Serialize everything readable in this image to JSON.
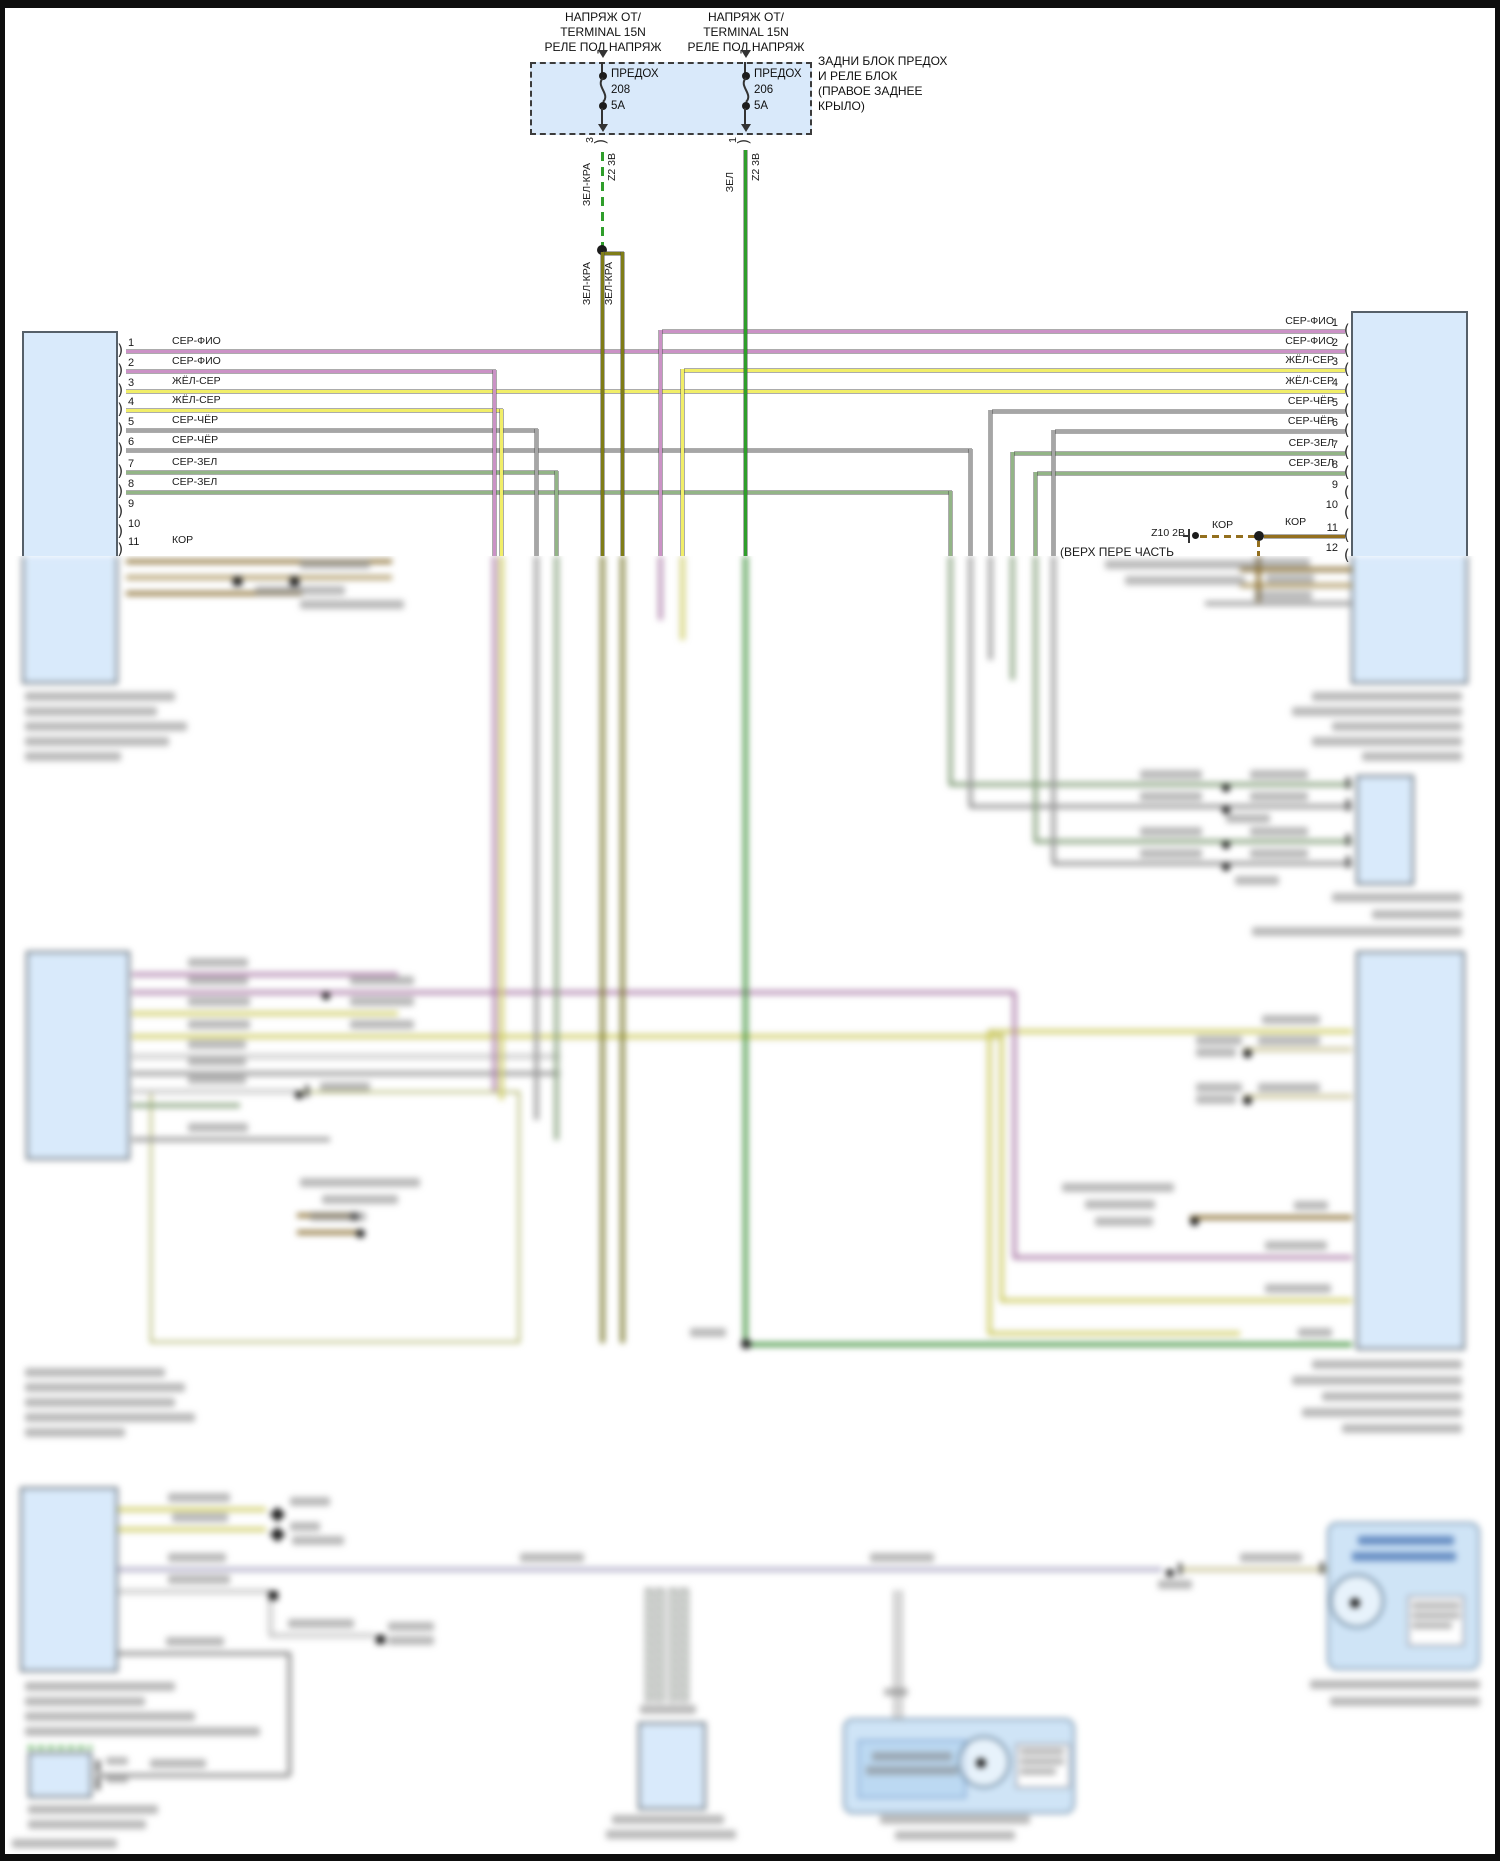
{
  "colors": {
    "pink": "#cb92c6",
    "yellow": "#f1ee68",
    "gray": "#a6a6a6",
    "green": "#93b587",
    "bright": "#2f9e2b",
    "olive": "#7f7d17",
    "brown": "#936f1e",
    "lavender": "#c7c3e6",
    "tan": "#c2a55e",
    "pale": "#ece5ad",
    "white": "#e3e3e3",
    "gray2": "#8a8a8a",
    "black": "#333333",
    "block_fill": "#d9eafb",
    "block_border": "#566069",
    "fusebox_fill": "#d9e9fa"
  },
  "top": {
    "feed_left": [
      "НАПРЯЖ ОТ/",
      "TERMINAL 15N",
      "РЕЛЕ ПОД НАПРЯЖ"
    ],
    "feed_right": [
      "НАПРЯЖ ОТ/",
      "TERMINAL 15N",
      "РЕЛЕ ПОД НАПРЯЖ"
    ],
    "box_label": [
      "ЗАДНИ БЛОК ПРЕДОХ",
      "И РЕЛЕ БЛОК",
      "(ПРАВОЕ ЗАДНЕЕ",
      "КРЫЛО)"
    ],
    "fuse_left": {
      "name": "ПРЕДОХ",
      "number": "208",
      "rating": "5А",
      "pin": "3",
      "wire": "ЗЕЛ-КРА",
      "circuit": "Z2 3В",
      "branch_wires": [
        "ЗЕЛ-КРА",
        "ЗЕЛ-КРА"
      ]
    },
    "fuse_right": {
      "name": "ПРЕДОХ",
      "number": "206",
      "rating": "5А",
      "pin": "1",
      "wire": "ЗЕЛ",
      "circuit": "Z2 3В"
    }
  },
  "left_connector": {
    "pins": [
      {
        "n": "1",
        "label": "СЕР-ФИО"
      },
      {
        "n": "2",
        "label": "СЕР-ФИО"
      },
      {
        "n": "3",
        "label": "ЖЁЛ-СЕР"
      },
      {
        "n": "4",
        "label": "ЖЁЛ-СЕР"
      },
      {
        "n": "5",
        "label": "СЕР-ЧЁР"
      },
      {
        "n": "6",
        "label": "СЕР-ЧЁР"
      },
      {
        "n": "7",
        "label": "СЕР-ЗЕЛ"
      },
      {
        "n": "8",
        "label": "СЕР-ЗЕЛ"
      },
      {
        "n": "9",
        "label": ""
      },
      {
        "n": "10",
        "label": ""
      },
      {
        "n": "11",
        "label": "КОР"
      }
    ]
  },
  "right_connector": {
    "pins": [
      {
        "n": "1",
        "label": "СЕР-ФИО"
      },
      {
        "n": "2",
        "label": "СЕР-ФИО"
      },
      {
        "n": "3",
        "label": "ЖЁЛ-СЕР"
      },
      {
        "n": "4",
        "label": "ЖЁЛ-СЕР"
      },
      {
        "n": "5",
        "label": "СЕР-ЧЁР"
      },
      {
        "n": "6",
        "label": "СЕР-ЧЁР"
      },
      {
        "n": "7",
        "label": "СЕР-ЗЕЛ"
      },
      {
        "n": "8",
        "label": "СЕР-ЗЕЛ"
      },
      {
        "n": "9",
        "label": ""
      },
      {
        "n": "10",
        "label": ""
      },
      {
        "n": "11",
        "label": "КОР"
      },
      {
        "n": "12",
        "label": ""
      }
    ]
  },
  "ground": {
    "id": "Z10 2В",
    "wire_left": "КОР",
    "wire_right": "КОР",
    "caption": "(ВЕРХ ПЕРЕ ЧАСТЬ"
  }
}
